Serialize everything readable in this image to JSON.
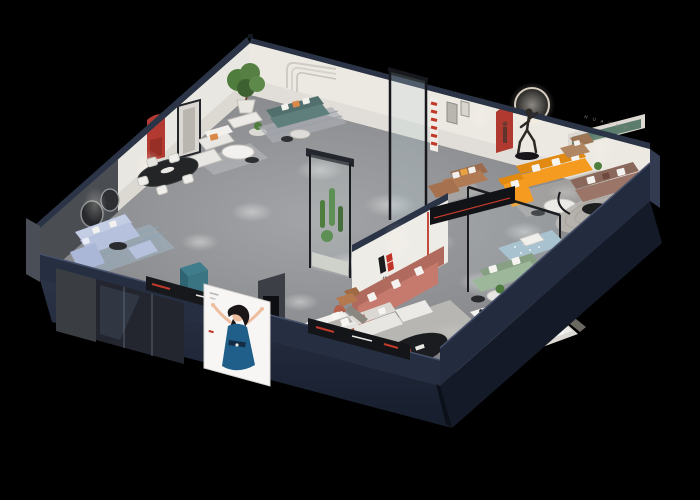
{
  "scene": {
    "type": "3d-isometric-cutaway-floorplan-render",
    "description": "Aerial cutaway 3D render of a furniture showroom apartment on a black background",
    "background": "#000000"
  },
  "brand": {
    "logo_letter": "H",
    "logo_characters": "华悦",
    "logo_black": "#1c1c1e",
    "logo_red": "#c23327",
    "wall_text": "H U A Y U E"
  },
  "palette": {
    "facade_navy": "#232c3f",
    "facade_navy_dark": "#141a28",
    "wall_white": "#e9e7e1",
    "wall_cap_navy": "#2b3447",
    "floor_gray": "#8e8f91",
    "rug_light": "#c2c0bc",
    "glass_tint": "#c8d8d2",
    "accent_red": "#b23a30"
  },
  "furniture_colors": {
    "periwinkle_sofa": "#b6c1dd",
    "teal_sofa": "#5e7f7c",
    "orange_sofa": "#f59b20",
    "caramel_sofa": "#b07a55",
    "salmon_sofa": "#c57a6d",
    "mauve_sofa": "#9a7568",
    "sage_sofa": "#9db79a",
    "blue_bed": "#a9c2cf",
    "tan_armchair": "#b08663",
    "dining_table": "#232527",
    "poster_dress_blue": "#1f5f8a",
    "terracotta_figure": "#b5604a",
    "plant_green": "#4e7d3e",
    "cube_teal": "#3f7d8c",
    "bed_white": "#efeeea"
  },
  "rooms": [
    {
      "name": "periwinkle-living-room",
      "items": "sectional sofa, media console, round wall art"
    },
    {
      "name": "dining-area",
      "items": "black oval table, four white chairs, red arched niche"
    },
    {
      "name": "white-lounge",
      "items": "white sofa set, coffee table, potted tree"
    },
    {
      "name": "teal-sofa-area",
      "items": "teal sofa, orange pillows, round side tables"
    },
    {
      "name": "caramel-sofa-area",
      "items": "caramel sofa, striped accent band"
    },
    {
      "name": "orange-sofa-room",
      "items": "orange L sectional, white coffee table, ring-light sculpture"
    },
    {
      "name": "mauve-sofa-room",
      "items": "mauve sofa, green recessed shelf, arc lamp"
    },
    {
      "name": "sage-bedroom",
      "items": "sage sofa, tufted blue bed, glass partition"
    },
    {
      "name": "master-bedroom",
      "items": "white bed, striped rug"
    },
    {
      "name": "brand-lounge",
      "items": "logo wall, salmon sofa, black oval table, media rail"
    },
    {
      "name": "center-bedroom",
      "items": "white bed, caramel armchair, dark TV wall"
    },
    {
      "name": "glass-atrium",
      "items": "glass tower with cacti, terracotta figure"
    }
  ],
  "poster": {
    "subject": "illustrated woman in blue dress with raised arms",
    "panel_color": "#f7f6f4"
  }
}
